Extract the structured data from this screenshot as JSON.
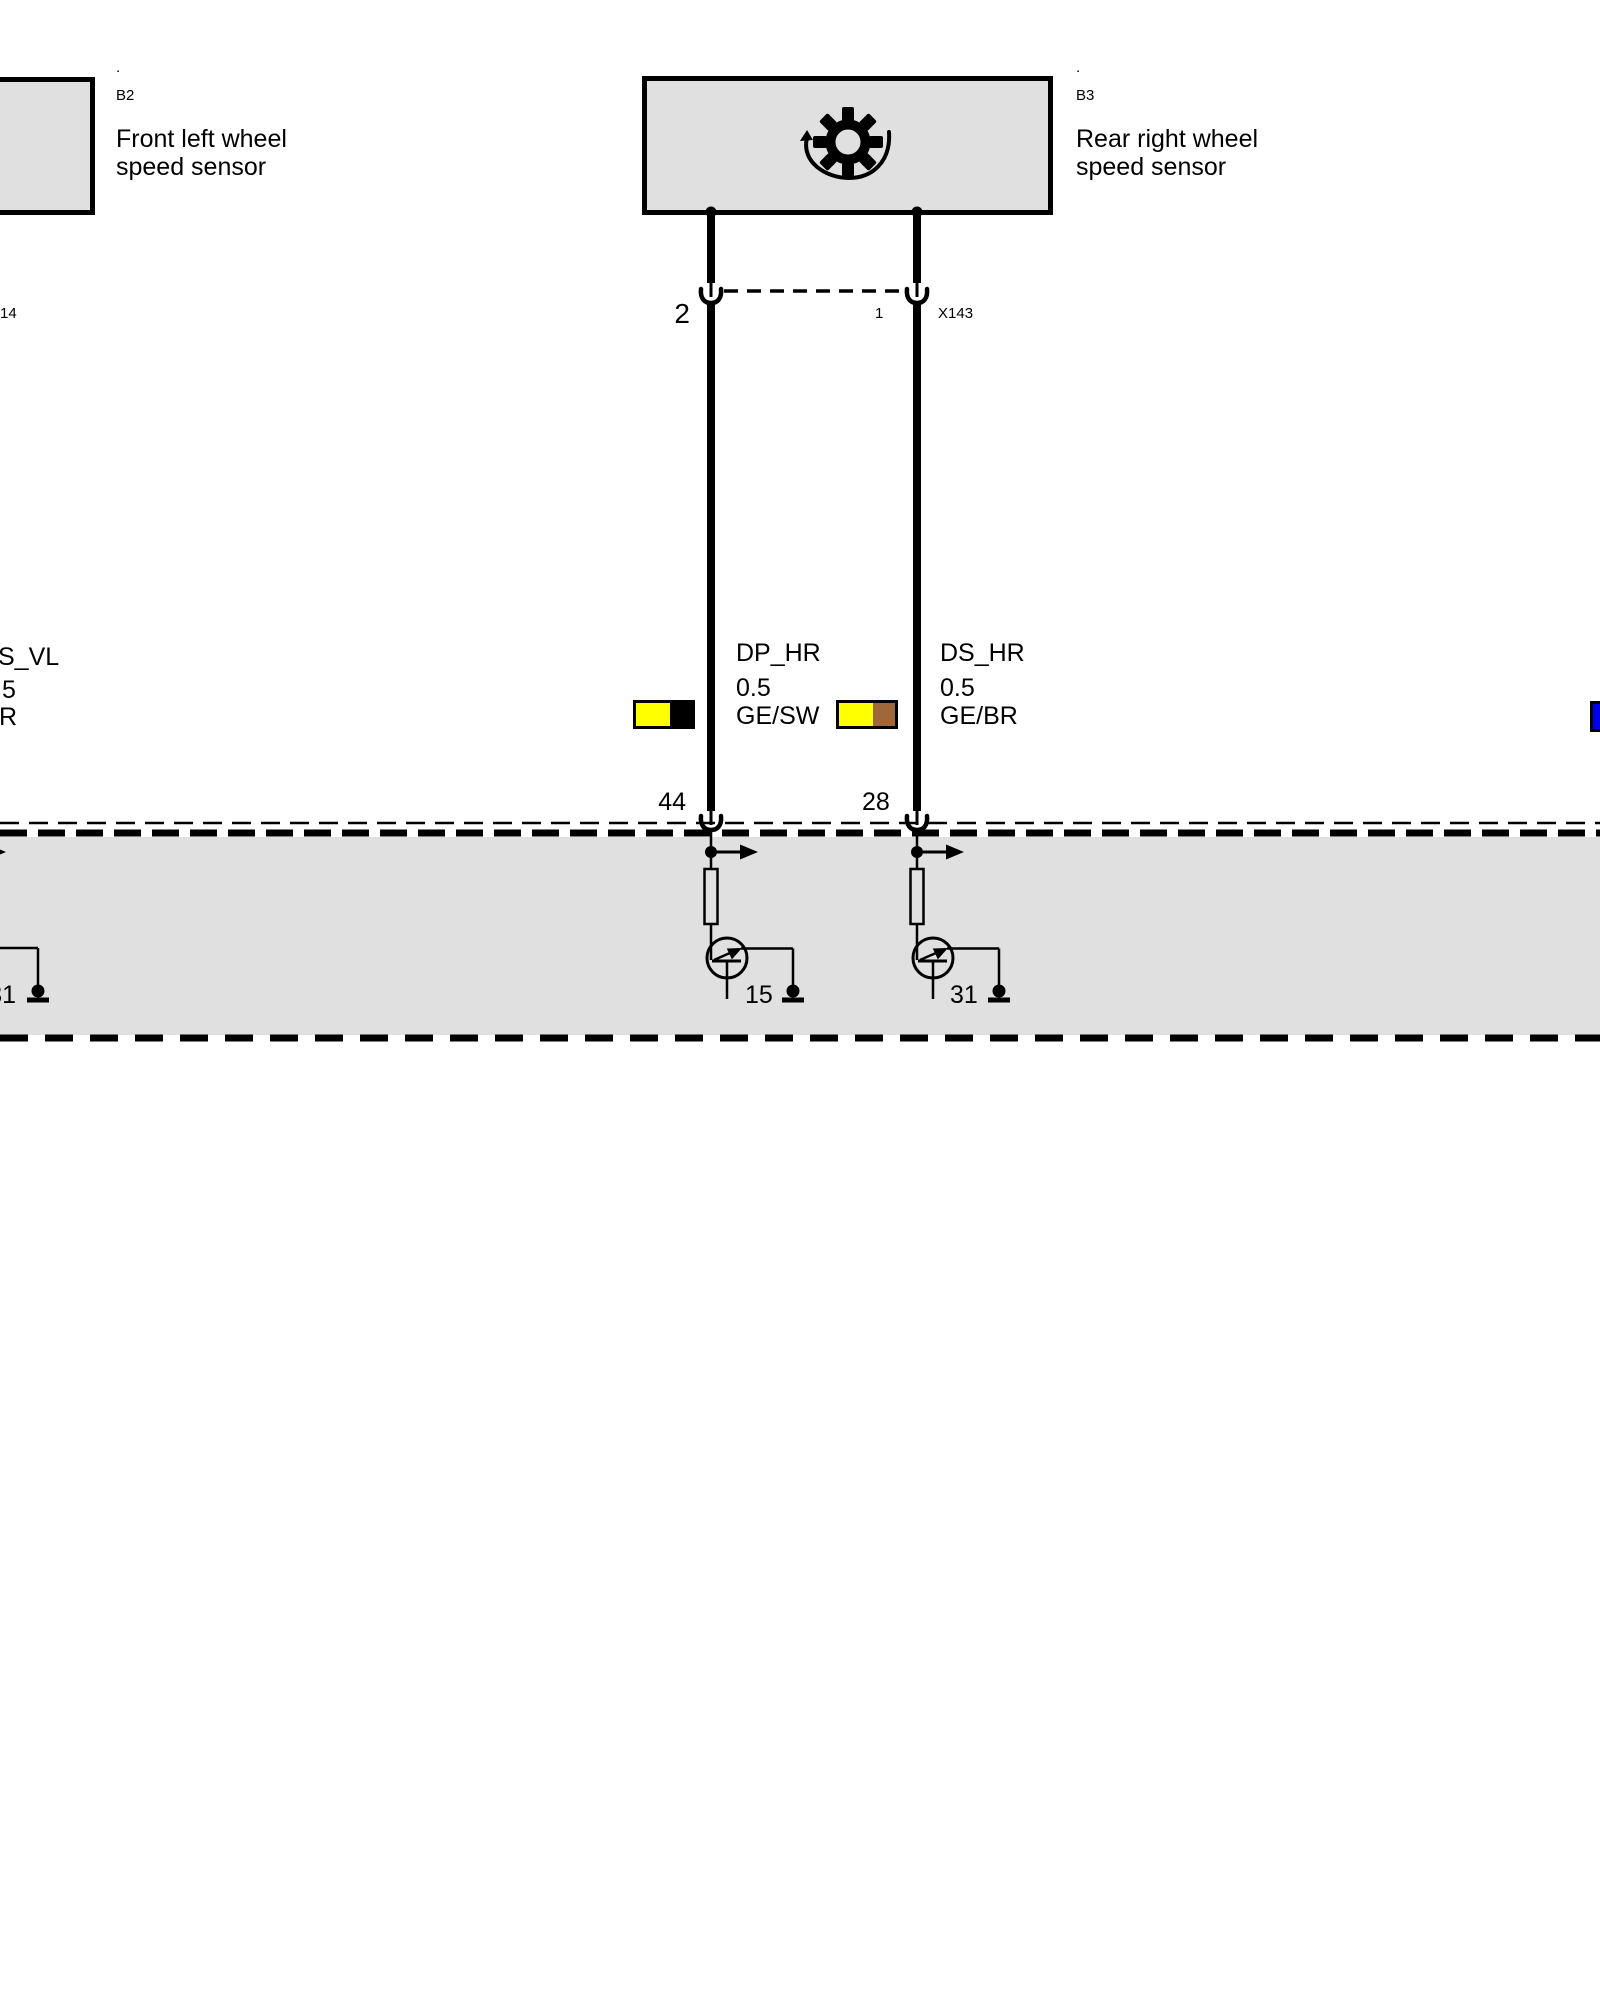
{
  "palette": {
    "box_fill": "#e0e0e0",
    "line": "#000000",
    "yellow": "#ffff00",
    "black": "#000000",
    "brown": "#a0673a",
    "blue": "#0000ee"
  },
  "sensors": {
    "left": {
      "dot": ".",
      "id": "B2",
      "name_line1": "Front left wheel",
      "name_line2": "speed sensor"
    },
    "right": {
      "dot": ".",
      "id": "B3",
      "name_line1": "Rear right wheel",
      "name_line2": "speed sensor"
    }
  },
  "connector_x143": {
    "left_pin": "2",
    "right_pin": "1",
    "label": "X143"
  },
  "left_edge": {
    "connector_label": "14",
    "wire_name": "S_VL",
    "wire_gauge": "5",
    "wire_color": "R",
    "internal_pin": "31"
  },
  "wires": {
    "dp_hr": {
      "name": "DP_HR",
      "gauge": "0.5",
      "color_code": "GE/SW",
      "ecu_pin": "44",
      "internal_pin": "15",
      "swatch_main": "#ffff00",
      "swatch_stripe": "#000000"
    },
    "ds_hr": {
      "name": "DS_HR",
      "gauge": "0.5",
      "color_code": "GE/BR",
      "ecu_pin": "28",
      "internal_pin": "31",
      "swatch_main": "#ffff00",
      "swatch_stripe": "#a0673a"
    }
  },
  "right_edge": {
    "swatch_main": "#0000ee"
  }
}
